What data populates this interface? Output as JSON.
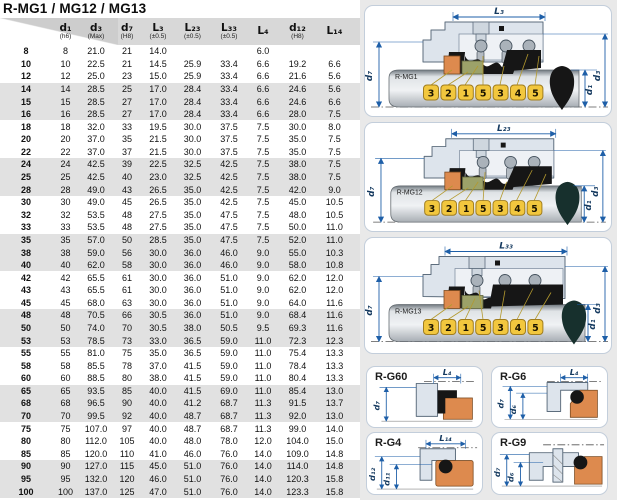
{
  "title": "R-MG1 / MG12 / MG13",
  "table": {
    "columns": [
      {
        "label": "",
        "note": ""
      },
      {
        "label": "d₁",
        "note": "(h6)"
      },
      {
        "label": "d₃",
        "note": "(Max)"
      },
      {
        "label": "d₇",
        "note": "(H8)"
      },
      {
        "label": "L₃",
        "note": "(±0.5)"
      },
      {
        "label": "L₂₃",
        "note": "(±0.5)"
      },
      {
        "label": "L₃₃",
        "note": "(±0.5)"
      },
      {
        "label": "L₄",
        "note": ""
      },
      {
        "label": "d₁₂",
        "note": "(H8)"
      },
      {
        "label": "L₁₄",
        "note": ""
      }
    ],
    "rows": [
      [
        "8",
        "8",
        "21.0",
        "21",
        "14.0",
        "",
        "",
        "6.0",
        "",
        ""
      ],
      [
        "10",
        "10",
        "22.5",
        "21",
        "14.5",
        "25.9",
        "33.4",
        "6.6",
        "19.2",
        "6.6"
      ],
      [
        "12",
        "12",
        "25.0",
        "23",
        "15.0",
        "25.9",
        "33.4",
        "6.6",
        "21.6",
        "5.6"
      ],
      [
        "14",
        "14",
        "28.5",
        "25",
        "17.0",
        "28.4",
        "33.4",
        "6.6",
        "24.6",
        "5.6"
      ],
      [
        "15",
        "15",
        "28.5",
        "27",
        "17.0",
        "28.4",
        "33.4",
        "6.6",
        "24.6",
        "6.6"
      ],
      [
        "16",
        "16",
        "28.5",
        "27",
        "17.0",
        "28.4",
        "33.4",
        "6.6",
        "28.0",
        "7.5"
      ],
      [
        "18",
        "18",
        "32.0",
        "33",
        "19.5",
        "30.0",
        "37.5",
        "7.5",
        "30.0",
        "8.0"
      ],
      [
        "20",
        "20",
        "37.0",
        "35",
        "21.5",
        "30.0",
        "37.5",
        "7.5",
        "35.0",
        "7.5"
      ],
      [
        "22",
        "22",
        "37.0",
        "37",
        "21.5",
        "30.0",
        "37.5",
        "7.5",
        "35.0",
        "7.5"
      ],
      [
        "24",
        "24",
        "42.5",
        "39",
        "22.5",
        "32.5",
        "42.5",
        "7.5",
        "38.0",
        "7.5"
      ],
      [
        "25",
        "25",
        "42.5",
        "40",
        "23.0",
        "32.5",
        "42.5",
        "7.5",
        "38.0",
        "7.5"
      ],
      [
        "28",
        "28",
        "49.0",
        "43",
        "26.5",
        "35.0",
        "42.5",
        "7.5",
        "42.0",
        "9.0"
      ],
      [
        "30",
        "30",
        "49.0",
        "45",
        "26.5",
        "35.0",
        "42.5",
        "7.5",
        "45.0",
        "10.5"
      ],
      [
        "32",
        "32",
        "53.5",
        "48",
        "27.5",
        "35.0",
        "47.5",
        "7.5",
        "48.0",
        "10.5"
      ],
      [
        "33",
        "33",
        "53.5",
        "48",
        "27.5",
        "35.0",
        "47.5",
        "7.5",
        "50.0",
        "11.0"
      ],
      [
        "35",
        "35",
        "57.0",
        "50",
        "28.5",
        "35.0",
        "47.5",
        "7.5",
        "52.0",
        "11.0"
      ],
      [
        "38",
        "38",
        "59.0",
        "56",
        "30.0",
        "36.0",
        "46.0",
        "9.0",
        "55.0",
        "10.3"
      ],
      [
        "40",
        "40",
        "62.0",
        "58",
        "30.0",
        "36.0",
        "46.0",
        "9.0",
        "58.0",
        "10.8"
      ],
      [
        "42",
        "42",
        "65.5",
        "61",
        "30.0",
        "36.0",
        "51.0",
        "9.0",
        "62.0",
        "12.0"
      ],
      [
        "43",
        "43",
        "65.5",
        "61",
        "30.0",
        "36.0",
        "51.0",
        "9.0",
        "62.0",
        "12.0"
      ],
      [
        "45",
        "45",
        "68.0",
        "63",
        "30.0",
        "36.0",
        "51.0",
        "9.0",
        "64.0",
        "11.6"
      ],
      [
        "48",
        "48",
        "70.5",
        "66",
        "30.5",
        "36.0",
        "51.0",
        "9.0",
        "68.4",
        "11.6"
      ],
      [
        "50",
        "50",
        "74.0",
        "70",
        "30.5",
        "38.0",
        "50.5",
        "9.5",
        "69.3",
        "11.6"
      ],
      [
        "53",
        "53",
        "78.5",
        "73",
        "33.0",
        "36.5",
        "59.0",
        "11.0",
        "72.3",
        "12.3"
      ],
      [
        "55",
        "55",
        "81.0",
        "75",
        "35.0",
        "36.5",
        "59.0",
        "11.0",
        "75.4",
        "13.3"
      ],
      [
        "58",
        "58",
        "85.5",
        "78",
        "37.0",
        "41.5",
        "59.0",
        "11.0",
        "78.4",
        "13.3"
      ],
      [
        "60",
        "60",
        "88.5",
        "80",
        "38.0",
        "41.5",
        "59.0",
        "11.0",
        "80.4",
        "13.3"
      ],
      [
        "65",
        "65",
        "93.5",
        "85",
        "40.0",
        "41.5",
        "69.0",
        "11.0",
        "85.4",
        "13.0"
      ],
      [
        "68",
        "68",
        "96.5",
        "90",
        "40.0",
        "41.2",
        "68.7",
        "11.3",
        "91.5",
        "13.7"
      ],
      [
        "70",
        "70",
        "99.5",
        "92",
        "40.0",
        "48.7",
        "68.7",
        "11.3",
        "92.0",
        "13.0"
      ],
      [
        "75",
        "75",
        "107.0",
        "97",
        "40.0",
        "48.7",
        "68.7",
        "11.3",
        "99.0",
        "14.0"
      ],
      [
        "80",
        "80",
        "112.0",
        "105",
        "40.0",
        "48.0",
        "78.0",
        "12.0",
        "104.0",
        "15.0"
      ],
      [
        "85",
        "85",
        "120.0",
        "110",
        "41.0",
        "46.0",
        "76.0",
        "14.0",
        "109.0",
        "14.8"
      ],
      [
        "90",
        "90",
        "127.0",
        "115",
        "45.0",
        "51.0",
        "76.0",
        "14.0",
        "114.0",
        "14.8"
      ],
      [
        "95",
        "95",
        "132.0",
        "120",
        "46.0",
        "51.0",
        "76.0",
        "14.0",
        "120.3",
        "15.8"
      ],
      [
        "100",
        "100",
        "137.0",
        "125",
        "47.0",
        "51.0",
        "76.0",
        "14.0",
        "123.3",
        "15.8"
      ]
    ]
  },
  "diagrams": [
    {
      "name": "R-MG1",
      "top": "L₃",
      "left": "d₇",
      "r1": "d₁",
      "r2": "d₃",
      "balloons": [
        "3",
        "2",
        "1",
        "5",
        "3",
        "4",
        "5"
      ]
    },
    {
      "name": "R-MG12",
      "top": "L₂₃",
      "left": "d₇",
      "r1": "d₁",
      "r2": "d₃",
      "balloons": [
        "3",
        "2",
        "1",
        "5",
        "3",
        "4",
        "5"
      ]
    },
    {
      "name": "R-MG13",
      "top": "L₃₃",
      "left": "d₇",
      "r1": "d₁",
      "r2": "d₃",
      "balloons": [
        "3",
        "2",
        "1",
        "5",
        "3",
        "4",
        "5"
      ]
    }
  ],
  "seats": [
    {
      "name": "R-G60",
      "top": "L₄",
      "v1": "d₇",
      "v2": ""
    },
    {
      "name": "R-G6",
      "top": "L₄",
      "v1": "d₇",
      "v2": "d₆"
    },
    {
      "name": "R-G4",
      "top": "L₁₄",
      "v1": "d₁₂",
      "v2": "d₁₁"
    },
    {
      "name": "R-G9",
      "top": "",
      "v1": "d₇",
      "v2": "d₆"
    }
  ],
  "colors": {
    "dimension_blue": "#1e5fa8",
    "balloon_yellow": "#f2c73e",
    "seat_orange": "#dd8a4e",
    "carbon_olive": "#9ca269",
    "steel_body": "#dde4ec",
    "elastomer_black": "#161616",
    "row_shade_gray": "#e1e1e1",
    "header_gray": "#d8d8d8"
  }
}
